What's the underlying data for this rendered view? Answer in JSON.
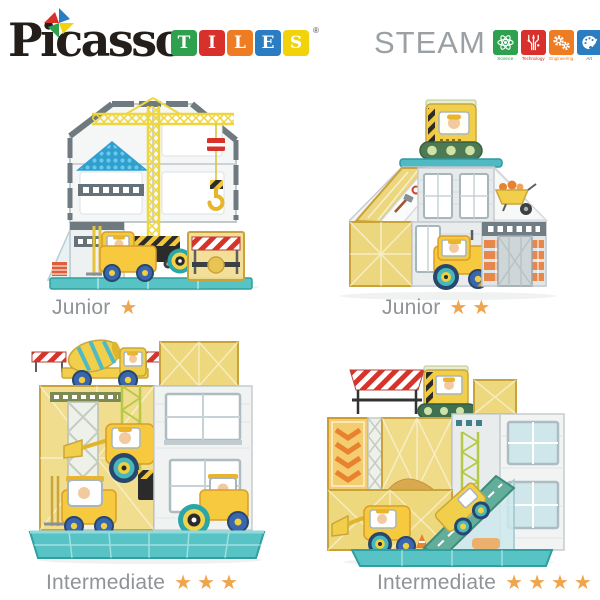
{
  "brand": {
    "name": "Picasso",
    "registered": "®",
    "tiles": [
      {
        "letter": "T",
        "color": "#2da14e"
      },
      {
        "letter": "I",
        "color": "#d8302a"
      },
      {
        "letter": "L",
        "color": "#ee7c23"
      },
      {
        "letter": "E",
        "color": "#2a7cc3"
      },
      {
        "letter": "S",
        "color": "#f2d20b"
      }
    ]
  },
  "steam": {
    "word": "STEAM",
    "word_color": "#9aa0a3",
    "items": [
      {
        "label": "Science",
        "color": "#2da14e",
        "icon": "atom-icon"
      },
      {
        "label": "Technology",
        "color": "#d8302a",
        "icon": "circuit-icon"
      },
      {
        "label": "Engineering",
        "color": "#ee7c23",
        "icon": "gears-icon"
      },
      {
        "label": "Art",
        "color": "#2a7cc3",
        "icon": "palette-icon"
      },
      {
        "label": "Mathematics",
        "color": "#f2d20b",
        "icon": "math-icon",
        "symbols": [
          "+",
          "−",
          "×",
          "÷"
        ]
      }
    ]
  },
  "products": [
    {
      "level": "Junior",
      "stars": "★",
      "star_count": 1
    },
    {
      "level": "Junior",
      "stars": "★★",
      "star_count": 2
    },
    {
      "level": "Intermediate",
      "stars": "★★★",
      "star_count": 3
    },
    {
      "level": "Intermediate",
      "stars": "★★★★",
      "star_count": 4
    }
  ],
  "colors": {
    "background": "#ffffff",
    "star": "#f0a44c",
    "caption_text": "#909497",
    "tile_gold": "#eed87e",
    "base_teal": "#57c3c5",
    "vehicle_yellow": "#f6c93f",
    "structure_gray": "#6e7980",
    "stripe_red": "#d8332b"
  }
}
